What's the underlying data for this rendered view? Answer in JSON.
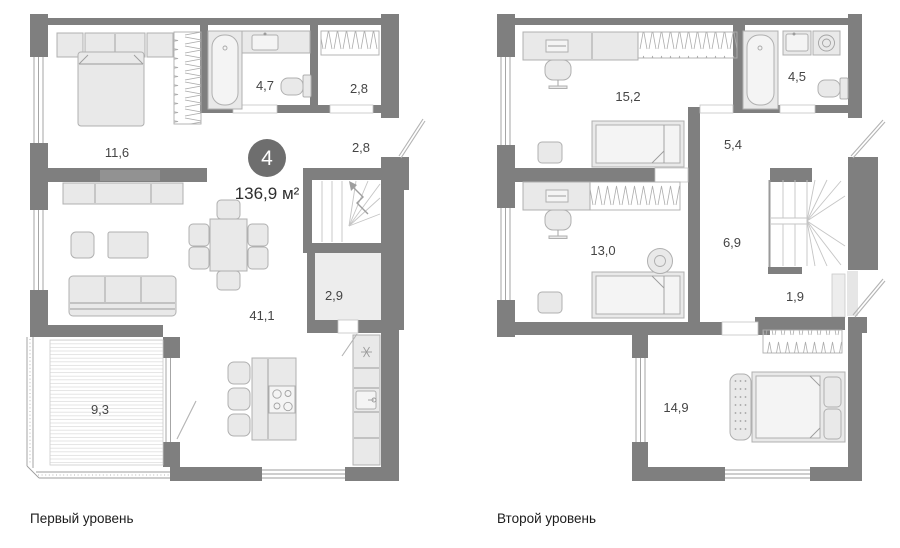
{
  "badge": {
    "rooms_count": "4",
    "total_area": "136,9 м²"
  },
  "level1": {
    "caption": "Первый уровень",
    "areas": {
      "bedroom": "11,6",
      "bathroom": "4,7",
      "hall_top": "2,8",
      "hall_entry": "2,8",
      "living_kitchen": "41,1",
      "storage": "2,9",
      "terrace": "9,3"
    }
  },
  "level2": {
    "caption": "Второй уровень",
    "areas": {
      "bedroom_large": "15,2",
      "bathroom": "4,5",
      "hall": "5,4",
      "bedroom_middle": "13,0",
      "corridor": "6,9",
      "closet": "1,9",
      "bedroom_master": "14,9"
    }
  },
  "colors": {
    "wall": "#7f7f7f",
    "badge": "#6e6e6e",
    "furniture_fill": "#e9e9e9",
    "furniture_stroke": "#b0b0b0"
  }
}
